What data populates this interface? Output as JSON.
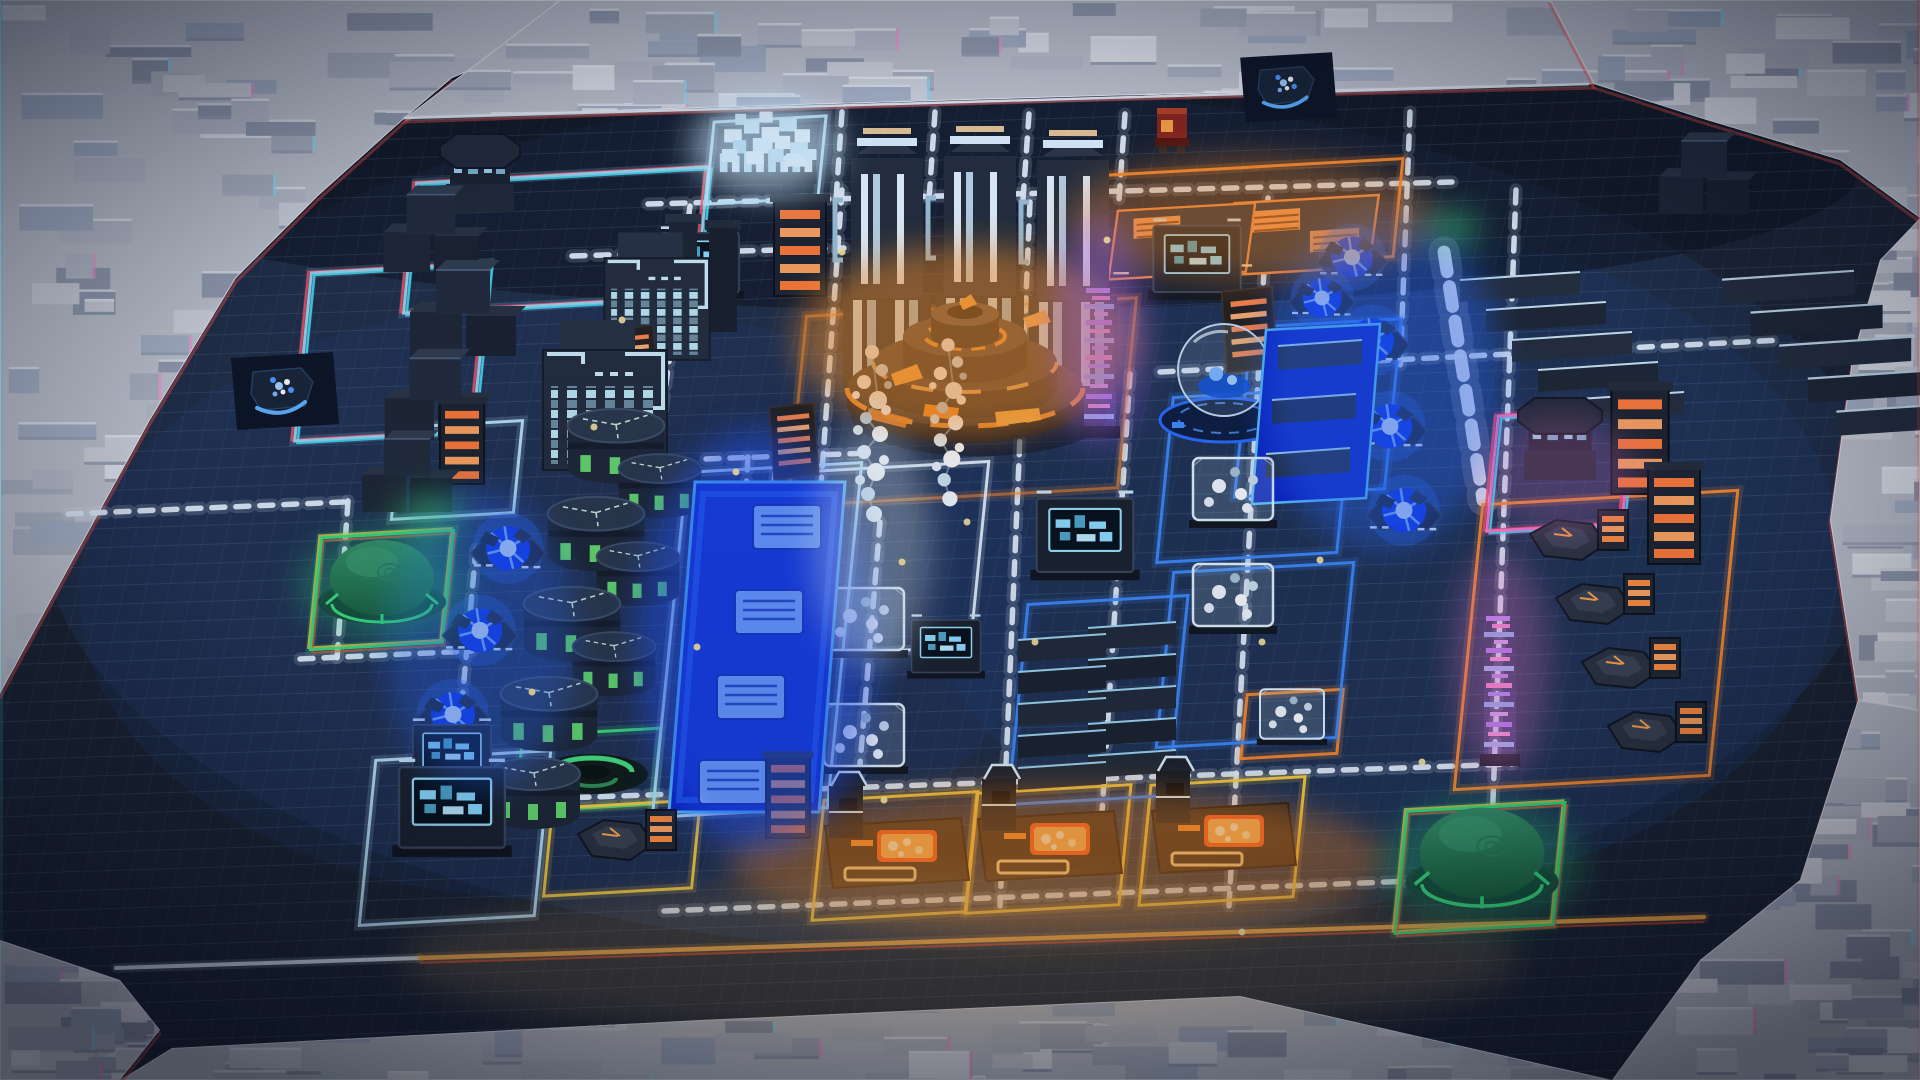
{
  "scene": {
    "kind": "isometric-factory-game-viewport",
    "hud_text": []
  },
  "palette": {
    "floor": "#1b2330",
    "grid_line": "rgba(140,180,220,0.15)",
    "road": "#e8f4ff",
    "road_orange": "#ffac40",
    "neon_cyan": "#bfeaff",
    "neon_blue": "#3f8cff",
    "neon_green": "#3fe07c",
    "neon_yellow": "#ffd23f",
    "neon_orange": "#ff8c2a",
    "neon_pink": "#ff7bd0",
    "reactor_glow": "#ff9320",
    "plasma_glow": "#2b6bff",
    "fringe_red": "#ff4a5a",
    "fringe_cyan": "#41e9ff"
  },
  "floor": {
    "color": "#1b2330",
    "lights": [
      [
        960,
        520,
        920,
        430,
        "#2a4470",
        0.32
      ],
      [
        560,
        600,
        480,
        300,
        "#1f3c6e",
        0.25
      ],
      [
        1380,
        560,
        460,
        330,
        "#1e3a70",
        0.3
      ],
      [
        960,
        170,
        900,
        140,
        "#0a0e16",
        0.5
      ]
    ]
  },
  "terrain": {
    "base": "#c9ccd4",
    "block_colors": [
      "#d9dce3",
      "#c2c6d0",
      "#eceef3",
      "#b4bac6",
      "#aeb9cc",
      "#9aa2b2"
    ],
    "fringe": [
      "#8fe8ff",
      "#ff9bd4"
    ],
    "regions": [
      {
        "name": "top-left-cliff",
        "blocks": 130,
        "points": [
          [
            0,
            0
          ],
          [
            560,
            0
          ],
          [
            500,
            58
          ],
          [
            452,
            78
          ],
          [
            405,
            118
          ],
          [
            318,
            196
          ],
          [
            236,
            278
          ],
          [
            150,
            420
          ],
          [
            84,
            540
          ],
          [
            0,
            694
          ]
        ]
      },
      {
        "name": "top-wall",
        "blocks": 80,
        "points": [
          [
            405,
            118
          ],
          [
            560,
            0
          ],
          [
            1550,
            0
          ],
          [
            1594,
            84
          ],
          [
            1100,
            96
          ],
          [
            700,
            108
          ]
        ]
      },
      {
        "name": "top-right-cliff",
        "blocks": 60,
        "points": [
          [
            1550,
            0
          ],
          [
            1920,
            0
          ],
          [
            1920,
            218
          ],
          [
            1840,
            160
          ],
          [
            1700,
            118
          ],
          [
            1594,
            84
          ]
        ]
      },
      {
        "name": "right-wall",
        "blocks": 45,
        "points": [
          [
            1920,
            218
          ],
          [
            1920,
            710
          ],
          [
            1858,
            700
          ],
          [
            1830,
            520
          ],
          [
            1852,
            360
          ],
          [
            1880,
            260
          ]
        ]
      },
      {
        "name": "bottom-right-cliff",
        "blocks": 70,
        "points": [
          [
            1920,
            710
          ],
          [
            1920,
            1080
          ],
          [
            1612,
            1080
          ],
          [
            1700,
            960
          ],
          [
            1800,
            880
          ],
          [
            1858,
            700
          ]
        ]
      },
      {
        "name": "bottom-wall",
        "blocks": 60,
        "points": [
          [
            120,
            1080
          ],
          [
            172,
            1048
          ],
          [
            700,
            1020
          ],
          [
            1240,
            996
          ],
          [
            1612,
            1080
          ]
        ]
      },
      {
        "name": "bottom-left-cliff",
        "blocks": 30,
        "points": [
          [
            0,
            940
          ],
          [
            120,
            980
          ],
          [
            160,
            1030
          ],
          [
            120,
            1080
          ],
          [
            0,
            1080
          ]
        ]
      }
    ]
  },
  "roads": [
    {
      "p": [
        405,
        118,
        1588,
        84
      ],
      "w": 2.5,
      "dash": "none",
      "c": "#f4f8ff"
    },
    {
      "p": [
        648,
        204,
        1452,
        182
      ]
    },
    {
      "p": [
        572,
        256,
        844,
        248
      ]
    },
    {
      "p": [
        1160,
        372,
        1782,
        340
      ]
    },
    {
      "p": [
        68,
        514,
        344,
        502
      ]
    },
    {
      "p": [
        480,
        801,
        1512,
        764
      ]
    },
    {
      "p": [
        664,
        911,
        1512,
        877
      ]
    },
    {
      "p": [
        300,
        659,
        472,
        651
      ]
    },
    {
      "p": [
        706,
        459,
        872,
        453
      ]
    },
    {
      "p": [
        690,
        206,
        656,
        458
      ]
    },
    {
      "p": [
        842,
        190,
        812,
        612
      ]
    },
    {
      "p": [
        1030,
        202,
        1000,
        906
      ]
    },
    {
      "p": [
        1268,
        198,
        1229,
        906
      ]
    },
    {
      "p": [
        1130,
        374,
        1102,
        812
      ]
    },
    {
      "p": [
        1516,
        190,
        1489,
        906
      ]
    },
    {
      "p": [
        880,
        522,
        857,
        800
      ]
    },
    {
      "p": [
        842,
        112,
        836,
        200
      ]
    },
    {
      "p": [
        935,
        112,
        929,
        200
      ]
    },
    {
      "p": [
        1029,
        114,
        1023,
        200
      ]
    },
    {
      "p": [
        1125,
        114,
        1119,
        200
      ]
    },
    {
      "p": [
        1410,
        112,
        1400,
        372
      ]
    },
    {
      "p": [
        748,
        457,
        727,
        808
      ]
    },
    {
      "p": [
        476,
        549,
        453,
        800
      ]
    },
    {
      "p": [
        348,
        501,
        337,
        659
      ]
    },
    {
      "p": [
        1444,
        252,
        1483,
        500
      ],
      "w": 13,
      "dash": "20 15",
      "c": "#f2f7fd"
    },
    {
      "p": [
        116,
        968,
        420,
        958
      ],
      "w": 4,
      "dash": "none",
      "c": "#dfe9f5"
    },
    {
      "p": [
        420,
        958,
        1704,
        917
      ],
      "w": 4.5,
      "dash": "none",
      "c": "#ffac40",
      "fr": "#ff4020"
    }
  ],
  "zones": [
    {
      "cx": 556,
      "cy": 240,
      "w": 292,
      "h": 130,
      "c": "#9fd8f0",
      "f": "rgb"
    },
    {
      "cx": 392,
      "cy": 352,
      "w": 178,
      "h": 168,
      "c": "#9fd8f0",
      "f": "rgb"
    },
    {
      "cx": 382,
      "cy": 590,
      "w": 132,
      "h": 112,
      "c": "#3fe07c",
      "f": "warm"
    },
    {
      "cx": 1480,
      "cy": 868,
      "w": 158,
      "h": 122,
      "c": "#3fe07c",
      "f": "warm"
    },
    {
      "cx": 588,
      "cy": 770,
      "w": 138,
      "h": 76,
      "c": "#3fe07c"
    },
    {
      "cx": 622,
      "cy": 848,
      "w": 148,
      "h": 88,
      "c": "#ffd23f"
    },
    {
      "cx": 895,
      "cy": 856,
      "w": 154,
      "h": 120,
      "c": "#ffd23f"
    },
    {
      "cx": 1048,
      "cy": 849,
      "w": 154,
      "h": 120,
      "c": "#ffd23f"
    },
    {
      "cx": 1222,
      "cy": 841,
      "w": 154,
      "h": 120,
      "c": "#ffd23f"
    },
    {
      "cx": 1248,
      "cy": 216,
      "w": 300,
      "h": 98,
      "c": "#ff8c2a"
    },
    {
      "cx": 1596,
      "cy": 640,
      "w": 255,
      "h": 285,
      "c": "#ff8c2a"
    },
    {
      "cx": 1292,
      "cy": 724,
      "w": 96,
      "h": 64,
      "c": "#ff8c2a"
    },
    {
      "cx": 962,
      "cy": 402,
      "w": 330,
      "h": 190,
      "c": "#ff8c2a",
      "o": 0.55
    },
    {
      "cx": 1560,
      "cy": 470,
      "w": 135,
      "h": 115,
      "c": "#ff7bd0",
      "f": "rgb"
    },
    {
      "cx": 455,
      "cy": 838,
      "w": 175,
      "h": 165,
      "c": "#bfeaff"
    },
    {
      "cx": 766,
      "cy": 160,
      "w": 112,
      "h": 82,
      "c": "#bfeaff"
    },
    {
      "cx": 457,
      "cy": 470,
      "w": 122,
      "h": 92,
      "c": "#bfeaff"
    },
    {
      "cx": 872,
      "cy": 560,
      "w": 215,
      "h": 185,
      "c": "#e8f6ff"
    },
    {
      "cx": 1255,
      "cy": 475,
      "w": 180,
      "h": 165,
      "c": "#3f8cff"
    },
    {
      "cx": 1255,
      "cy": 655,
      "w": 180,
      "h": 175,
      "c": "#3f8cff"
    },
    {
      "cx": 1098,
      "cy": 700,
      "w": 160,
      "h": 200,
      "c": "#3f8cff"
    },
    {
      "cx": 1318,
      "cy": 408,
      "w": 150,
      "h": 170,
      "c": "#3f8cff"
    },
    {
      "cx": 757,
      "cy": 640,
      "w": 175,
      "h": 345,
      "c": "#bfeaff"
    }
  ],
  "buildings": [
    {
      "t": "octagon",
      "x": 480,
      "y": 212,
      "s": 1
    },
    {
      "t": "cubestack",
      "x": 432,
      "y": 272,
      "s": 0.9
    },
    {
      "t": "cubestack",
      "x": 464,
      "y": 356,
      "s": 1
    },
    {
      "t": "cubestack",
      "x": 436,
      "y": 440,
      "s": 0.95
    },
    {
      "t": "cubestack",
      "x": 408,
      "y": 512,
      "s": 0.85
    },
    {
      "t": "citytower",
      "x": 605,
      "y": 470,
      "s": 1
    },
    {
      "t": "citytower",
      "x": 657,
      "y": 360,
      "s": 0.85
    },
    {
      "t": "towerpair",
      "x": 703,
      "y": 332,
      "s": 1
    },
    {
      "t": "crystal",
      "x": 766,
      "y": 182,
      "s": 1.1
    },
    {
      "t": "monolith",
      "x": 887,
      "y": 390,
      "s": 1
    },
    {
      "t": "monolith",
      "x": 980,
      "y": 388,
      "s": 1
    },
    {
      "t": "monolith",
      "x": 1073,
      "y": 392,
      "s": 1
    },
    {
      "t": "screenbox",
      "x": 700,
      "y": 294,
      "s": 0.85
    },
    {
      "t": "rack",
      "x": 800,
      "y": 296,
      "s": 1
    },
    {
      "t": "reactor",
      "x": 965,
      "y": 398,
      "s": 1
    },
    {
      "t": "stair",
      "x": 1245,
      "y": 362,
      "s": 0.9
    },
    {
      "t": "solarpad",
      "x": 1185,
      "y": 242,
      "s": 0.78
    },
    {
      "t": "solarpad",
      "x": 1305,
      "y": 236,
      "s": 0.82
    },
    {
      "t": "holo",
      "x": 1100,
      "y": 434,
      "s": 1
    },
    {
      "t": "screenbox",
      "x": 1197,
      "y": 294,
      "s": 0.95
    },
    {
      "t": "drone",
      "x": 1172,
      "y": 154,
      "s": 1
    },
    {
      "t": "emblem",
      "x": 1287,
      "y": 90,
      "s": 0.9
    },
    {
      "t": "emblem",
      "x": 283,
      "y": 394,
      "s": 1
    },
    {
      "t": "rack",
      "x": 462,
      "y": 484,
      "s": 0.85
    },
    {
      "t": "stair",
      "x": 632,
      "y": 384,
      "s": 0.7
    },
    {
      "t": "plasma",
      "x": 508,
      "y": 562,
      "s": 0.85
    },
    {
      "t": "plasma",
      "x": 480,
      "y": 644,
      "s": 0.85
    },
    {
      "t": "plasma",
      "x": 453,
      "y": 728,
      "s": 0.85
    },
    {
      "t": "tank",
      "x": 616,
      "y": 474,
      "s": 1.05
    },
    {
      "t": "tank",
      "x": 596,
      "y": 562,
      "s": 1.05
    },
    {
      "t": "tank",
      "x": 572,
      "y": 652,
      "s": 1.05
    },
    {
      "t": "tank",
      "x": 549,
      "y": 742,
      "s": 1.05
    },
    {
      "t": "tank",
      "x": 534,
      "y": 820,
      "s": 1
    },
    {
      "t": "tank",
      "x": 660,
      "y": 510,
      "s": 0.9
    },
    {
      "t": "tank",
      "x": 638,
      "y": 598,
      "s": 0.9
    },
    {
      "t": "tank",
      "x": 614,
      "y": 688,
      "s": 0.9
    },
    {
      "t": "dome",
      "x": 382,
      "y": 602,
      "s": 1
    },
    {
      "t": "greenring",
      "x": 592,
      "y": 774,
      "s": 1
    },
    {
      "t": "beltstrip",
      "x": 757,
      "y": 812,
      "s": 1
    },
    {
      "t": "stair",
      "x": 790,
      "y": 470,
      "s": 0.8
    },
    {
      "t": "molecule",
      "x": 872,
      "y": 530,
      "s": 1
    },
    {
      "t": "molecule",
      "x": 948,
      "y": 514,
      "s": 0.95
    },
    {
      "t": "glasscube",
      "x": 864,
      "y": 654,
      "s": 1
    },
    {
      "t": "glasscube",
      "x": 864,
      "y": 770,
      "s": 1
    },
    {
      "t": "screenbox",
      "x": 946,
      "y": 674,
      "s": 0.75
    },
    {
      "t": "slabtower",
      "x": 1062,
      "y": 790,
      "s": 1
    },
    {
      "t": "slabtower",
      "x": 1132,
      "y": 778,
      "s": 1
    },
    {
      "t": "screenbox",
      "x": 1085,
      "y": 574,
      "s": 1.05
    },
    {
      "t": "sphere",
      "x": 1224,
      "y": 414,
      "s": 1
    },
    {
      "t": "beltslab",
      "x": 1318,
      "y": 496,
      "s": 1
    },
    {
      "t": "plasma",
      "x": 1352,
      "y": 270,
      "s": 0.8
    },
    {
      "t": "plasma",
      "x": 1372,
      "y": 354,
      "s": 0.85
    },
    {
      "t": "plasma",
      "x": 1390,
      "y": 440,
      "s": 0.85
    },
    {
      "t": "plasma",
      "x": 1404,
      "y": 524,
      "s": 0.85
    },
    {
      "t": "plasma",
      "x": 1322,
      "y": 310,
      "s": 0.75
    },
    {
      "t": "plasma",
      "x": 1340,
      "y": 394,
      "s": 0.75
    },
    {
      "t": "slabcascade",
      "x": 1520,
      "y": 444,
      "s": 1
    },
    {
      "t": "slabcascade",
      "x": 1788,
      "y": 460,
      "s": 1.1
    },
    {
      "t": "cubestack",
      "x": 1705,
      "y": 214,
      "s": 0.85
    },
    {
      "t": "octagon",
      "x": 1560,
      "y": 480,
      "s": 1.05
    },
    {
      "t": "holo",
      "x": 1500,
      "y": 762,
      "s": 1
    },
    {
      "t": "rack",
      "x": 1640,
      "y": 494,
      "s": 1.1
    },
    {
      "t": "rack",
      "x": 1674,
      "y": 564,
      "s": 1
    },
    {
      "t": "hexmach",
      "x": 1568,
      "y": 554,
      "s": 1
    },
    {
      "t": "hexmach",
      "x": 1594,
      "y": 618,
      "s": 1
    },
    {
      "t": "hexmach",
      "x": 1620,
      "y": 682,
      "s": 1
    },
    {
      "t": "hexmach",
      "x": 1646,
      "y": 746,
      "s": 1
    },
    {
      "t": "glasscube",
      "x": 1233,
      "y": 524,
      "s": 1
    },
    {
      "t": "glasscube",
      "x": 1233,
      "y": 630,
      "s": 1
    },
    {
      "t": "glasscube",
      "x": 1292,
      "y": 742,
      "s": 0.8
    },
    {
      "t": "smelter",
      "x": 895,
      "y": 870,
      "s": 1
    },
    {
      "t": "smelter",
      "x": 1048,
      "y": 863,
      "s": 1
    },
    {
      "t": "smelter",
      "x": 1222,
      "y": 855,
      "s": 1
    },
    {
      "t": "hexmach",
      "x": 616,
      "y": 854,
      "s": 1
    },
    {
      "t": "screenbox",
      "x": 452,
      "y": 850,
      "s": 1.15
    },
    {
      "t": "screenbox",
      "x": 452,
      "y": 786,
      "s": 0.85
    },
    {
      "t": "dome",
      "x": 1482,
      "y": 882,
      "s": 1.2
    },
    {
      "t": "rack",
      "x": 788,
      "y": 838,
      "s": 0.85
    }
  ],
  "glows": [
    [
      965,
      340,
      170,
      95,
      "#ff9320",
      0.5
    ],
    [
      1060,
      862,
      330,
      75,
      "#ff8c1a",
      0.4
    ],
    [
      757,
      640,
      120,
      210,
      "#2255ff",
      0.5
    ],
    [
      1382,
      380,
      120,
      170,
      "#2b6bff",
      0.4
    ],
    [
      480,
      640,
      95,
      150,
      "#2b6bff",
      0.35
    ],
    [
      766,
      145,
      75,
      50,
      "#cfeeff",
      0.65
    ],
    [
      382,
      585,
      85,
      55,
      "#27e07c",
      0.3
    ],
    [
      1482,
      865,
      100,
      65,
      "#27e07c",
      0.3
    ],
    [
      1250,
      218,
      185,
      62,
      "#ff8c1a",
      0.35
    ],
    [
      1100,
      330,
      45,
      115,
      "#b06bff",
      0.4
    ],
    [
      1500,
      665,
      48,
      115,
      "#ff7bd0",
      0.3
    ],
    [
      960,
      960,
      560,
      80,
      "#ffc978",
      0.18
    ],
    [
      429,
      517,
      34,
      22,
      "#3fe07c",
      0.5
    ],
    [
      1453,
      228,
      28,
      18,
      "#3fe07c",
      0.5
    ],
    [
      872,
      545,
      60,
      120,
      "#dff2ff",
      0.35
    ],
    [
      1560,
      475,
      80,
      60,
      "#ff7bd0",
      0.22
    ]
  ],
  "sparks": [
    [
      594,
      427
    ],
    [
      736,
      472
    ],
    [
      902,
      562
    ],
    [
      1035,
      642
    ],
    [
      842,
      252
    ],
    [
      1262,
      642
    ],
    [
      697,
      647
    ],
    [
      1422,
      762
    ],
    [
      1107,
      240
    ],
    [
      967,
      522
    ],
    [
      532,
      692
    ],
    [
      1242,
      932
    ],
    [
      884,
      800
    ],
    [
      1320,
      560
    ],
    [
      622,
      320
    ]
  ]
}
